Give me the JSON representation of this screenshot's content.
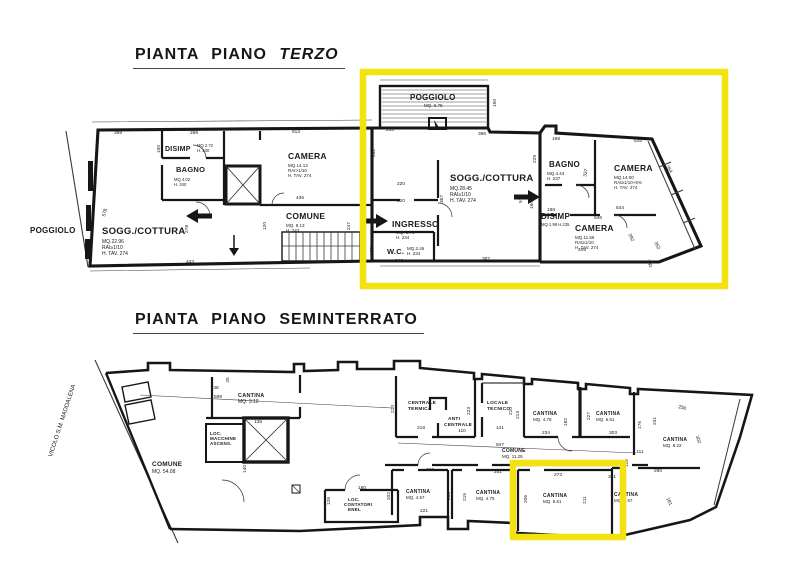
{
  "colors": {
    "highlight": "#F2E20D",
    "ink": "#1b1b1b"
  },
  "titles": {
    "plan1_prefix": "PIANTA PIANO",
    "plan1_name": "TERZO",
    "plan2": "PIANTA PIANO SEMINTERRATO"
  },
  "terzo": {
    "labels": [
      "POGGIOLO",
      "SOGG./COTTURA",
      "MQ.22.96",
      "RAI≥1/10",
      "H. TAV. 274",
      "DISIMP",
      "MQ 2.72",
      "H. 240",
      "BAGNO",
      "MQ 4.02",
      "H. 240",
      "CAMERA",
      "MQ.14.13",
      "RAI>1/10",
      "H. TAV. 274",
      "COMUNE",
      "MQ. 9.13",
      "H. 243",
      "POGGIOLO",
      "MQ. 6.75",
      "SOGG./COTTURA",
      "MQ.28.45",
      "RAI≥1/10",
      "H. TAV. 274",
      "INGRESSO",
      "MQ. 3.76",
      "H. 234",
      "W.C.",
      "MQ.2.46",
      "H. 234",
      "BAGNO",
      "MQ.4.44",
      "H. 237",
      "DISIMP",
      "MQ.1.98 H.235",
      "CAMERA",
      "MQ.14.00",
      "RAI≥1/10+5%",
      "H. TAV. 274",
      "CAMERA",
      "MQ.11.56",
      "RAI≥1/10",
      "H. TAV. 274"
    ],
    "dims": [
      "369",
      "269",
      "613",
      "100",
      "443",
      "578",
      "278",
      "120",
      "247",
      "436",
      "218",
      "386",
      "150",
      "262",
      "220",
      "220",
      "367",
      "575",
      "171",
      "102",
      "242",
      "387",
      "198",
      "516",
      "229",
      "337",
      "188",
      "160",
      "544",
      "546",
      "354",
      "392",
      "352",
      "405",
      "280"
    ]
  },
  "semi": {
    "labels": [
      "COMUNE",
      "MQ. 54.08",
      "CANTINA",
      "MQ. 3.10",
      "LOC.",
      "MACCHINE",
      "ASCENS.",
      "LOC.",
      "CONTATORI",
      "ENEL",
      "CENTRALE",
      "TERMICA",
      "ANTI",
      "CENTRALE",
      "LOCALE",
      "TECNICO",
      "COMUNE",
      "MQ. 11.25",
      "CANTINA",
      "MQ. 4.78",
      "CANTINA",
      "MQ. 6.51",
      "CANTINA",
      "MQ. 8.22",
      "CANTINA",
      "MQ. 4.57",
      "CANTINA",
      "MQ. 4.75",
      "CANTINA",
      "MQ. 5.51",
      "CANTINA",
      "MQ. 6.57",
      "VICOLO  S.M.  MADDALENA"
    ],
    "dims": [
      "599",
      "38",
      "25",
      "135",
      "140",
      "180",
      "126",
      "221",
      "210",
      "218",
      "110",
      "223",
      "141",
      "210",
      "947",
      "213",
      "234",
      "182",
      "227",
      "303",
      "176",
      "231",
      "250",
      "302",
      "111",
      "119",
      "290",
      "371",
      "220",
      "202",
      "210",
      "251",
      "215",
      "208",
      "273",
      "206",
      "211",
      "181"
    ]
  }
}
